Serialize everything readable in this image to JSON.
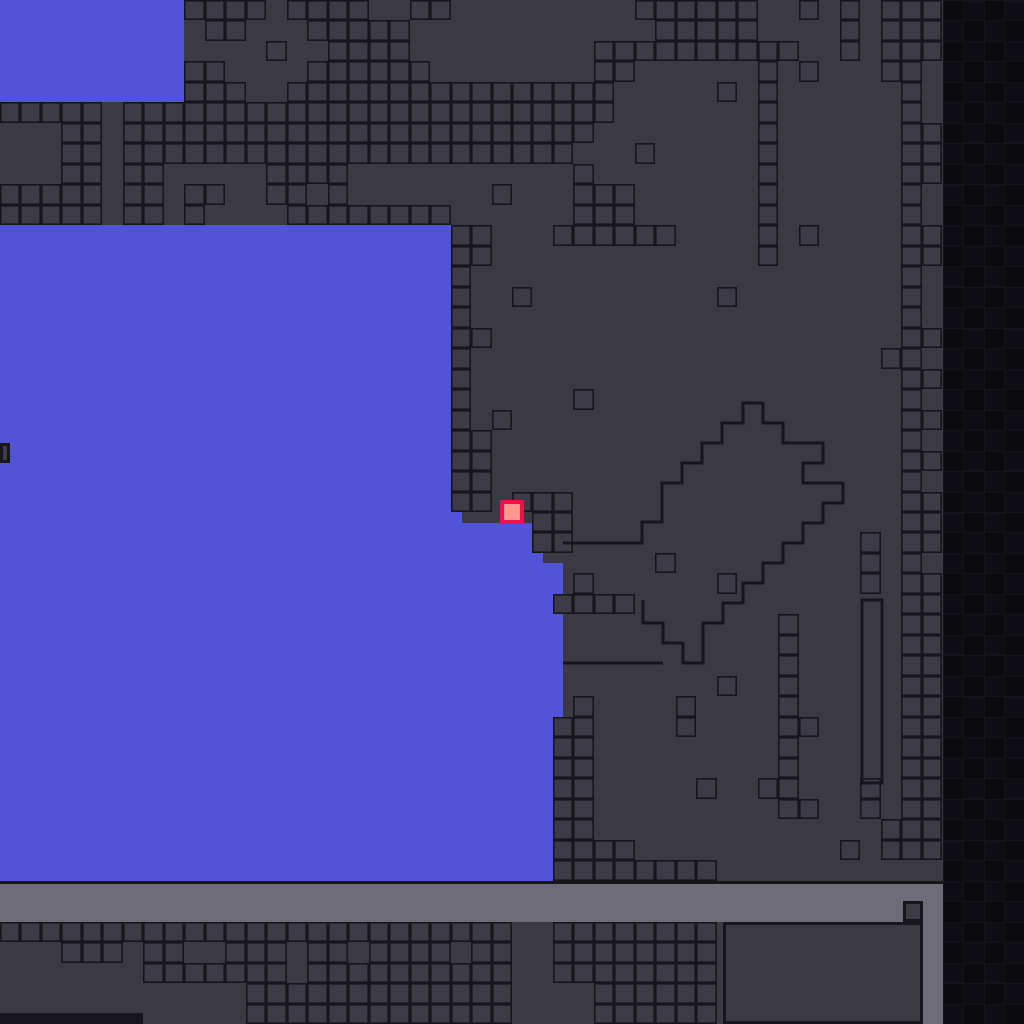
{
  "meta": {
    "app": "pixel-platformer-level-view",
    "description": "Tile-based platformer level: dark terrain with outlined tiles, blue open areas, player square, gray platform bar, dark right strip",
    "viewport": {
      "width": 1024,
      "height": 1024
    }
  },
  "palette": {
    "base_bg": "#3b3a43",
    "tile_fill": "#3d3c46",
    "tile_border": "#17161d",
    "blue": "#5254d8",
    "gray_bar": "#6e6c78",
    "dark_strip_bg": "#14131a",
    "dark_cell_a": "#0b0a0f",
    "dark_cell_b": "#0f0e14",
    "player_fill": "#ff958f",
    "player_border": "#f0104a",
    "black_line": "#17161d"
  },
  "grid": {
    "cols": 50,
    "rows": 50,
    "cell": 20.48,
    "tile_border_px": 1.6
  },
  "player": {
    "x": 500,
    "y": 500,
    "w": 24,
    "h": 24,
    "border_px": 4
  },
  "regions": [
    {
      "name": "blue-area-top-left",
      "x": 0,
      "y": 0,
      "w": 184,
      "h": 102,
      "color": "blue"
    },
    {
      "name": "blue-area-main",
      "x": 0,
      "y": 225,
      "w": 462,
      "h": 659,
      "color": "blue"
    },
    {
      "name": "blue-area-step-under-player",
      "x": 462,
      "y": 523,
      "w": 81,
      "h": 361,
      "color": "blue"
    },
    {
      "name": "blue-area-step-right",
      "x": 543,
      "y": 563,
      "w": 20,
      "h": 321,
      "color": "blue"
    },
    {
      "name": "platform-bar-top-line",
      "x": 0,
      "y": 881,
      "w": 943,
      "h": 3,
      "color": "black_line"
    },
    {
      "name": "platform-bar",
      "x": 0,
      "y": 884,
      "w": 943,
      "h": 38,
      "color": "gray_bar"
    },
    {
      "name": "platform-bar-right-arm",
      "x": 923,
      "y": 922,
      "w": 20,
      "h": 102,
      "color": "gray_bar"
    },
    {
      "name": "bar-notch-square",
      "x": 903,
      "y": 901,
      "w": 20,
      "h": 21,
      "color": "tile_fill",
      "border": true
    },
    {
      "name": "big-outlined-box-bottom",
      "x": 723,
      "y": 922,
      "w": 200,
      "h": 102,
      "color": "base_bg",
      "border": true
    },
    {
      "name": "bottom-left-black-strip",
      "x": 0,
      "y": 1013,
      "w": 143,
      "h": 11,
      "color": "black_line"
    },
    {
      "name": "blue-left-edge-notch",
      "x": 0,
      "y": 443,
      "w": 10,
      "h": 20,
      "color": "tile_fill",
      "border": true
    },
    {
      "name": "dark-right-strip",
      "x": 943,
      "y": 0,
      "w": 81,
      "h": 1024,
      "color": "dark_strip_bg"
    }
  ],
  "dark_strip": {
    "x": 943,
    "y": 0,
    "cols": 4,
    "rows": 50,
    "cell_w": 20.25,
    "cell_h": 20.48,
    "gap": 1
  },
  "outline_shapes": {
    "stroke_px": 3,
    "stairs_path": "M563 543 H642 V522 H662 V483 H682 V463 H702 V443 H722 V423 H743 V403 H763 V423 H783 V443 H823 V463 H803 V483 H843 V503 H823 V523 H803 V543 H783 V563 H763 V583 H743 V603 H723 V623 H703 V663 H683 V643 H663 V623 H643 V600",
    "ground_line_path": "M563 663 H663",
    "tall_column_rect": {
      "x": 862,
      "y": 600,
      "w": 20,
      "h": 183
    }
  },
  "tile_map": {
    "legend": {
      ".": "empty-background",
      "T": "outlined-terrain-tile"
    },
    "rows": [
      ".........TTTT.TTTT..TT.........TTTTTT..T.T.TTT....",
      "..........TT...TTTTT............TTTTT....T.TTT....",
      ".............T..TTTT.........TTTTTTTTTT..T.TTT....",
      ".........TT....TTTTTT........TT......T.T...TT.....",
      ".........TTT..TTTTTTTTTTTTTTTT.....T.T......T.....",
      "TTTTT.TTTTTTTTTTTTTTTTTTTTTTTT.......T......T.....",
      "...TT.TTTTTTTTTTTTTTTTTTTTTTT........T......TT....",
      "...TT.TTTTTTTTTTTTTTTTTTTTTT...T.....T......TT....",
      "...TT.TT.....TTTT...........T........T......TT....",
      "TTTTT.TT.TT..TT.T.......T...TTT......T......T.....",
      "TTTTT.TT.T....TTTTTTTT......TTT......T......T.....",
      "......................TT...TTTTTT....T.T....TT....",
      "......................TT.............T......TT....",
      "......................T.....................T.....",
      "......................T..T.........T........T.....",
      "......................T.....................T.....",
      "......................TT....................TT....",
      "......................T....................TT.....",
      "......................T.....................TT....",
      "......................T.....T...............T.....",
      "......................T.T...................TT....",
      "......................TT....................T.....",
      "......................TT....................TT....",
      "......................TT....................T.....",
      "......................TT.TTT................TT....",
      "..........................TT................TT....",
      "..........................TT..............T.TT....",
      "................................T.........T.T.....",
      "............................T......T......T.TT....",
      "...........................TTTT.............TT....",
      "......................................T.....TT....",
      "......................................T.....TT....",
      "......................................T.....TT....",
      "...................................T..T.....TT....",
      "............................T....T....T.....TT....",
      "...........................TT....T....TT....TT....",
      "...........................TT.........T.....TT....",
      "...........................TT.........T.....TT....",
      "...........................TT.....T..TT...T.TT....",
      "...........................TT.........TT..T.TT....",
      "...........................TT..............TTT....",
      "...........................TTTT..........T.TTT....",
      "...........................TTTTTTTT...............",
      "..................................................",
      "..................................................",
      "TTTTTTTTTTTTTTTTTTTTTTTTT..TTTTTTTT...............",
      "...TTT.TT..TTT.TT.TTTT.TT..TTTTTTTT...............",
      ".......TTTTTTT.TTTTTTTTTT..TTTTTTTT...............",
      "............TTTTTTTTTTTTT....TTTTTT...............",
      "............TTTTTTTTTTTTT....TTTTTT..............."
    ]
  }
}
